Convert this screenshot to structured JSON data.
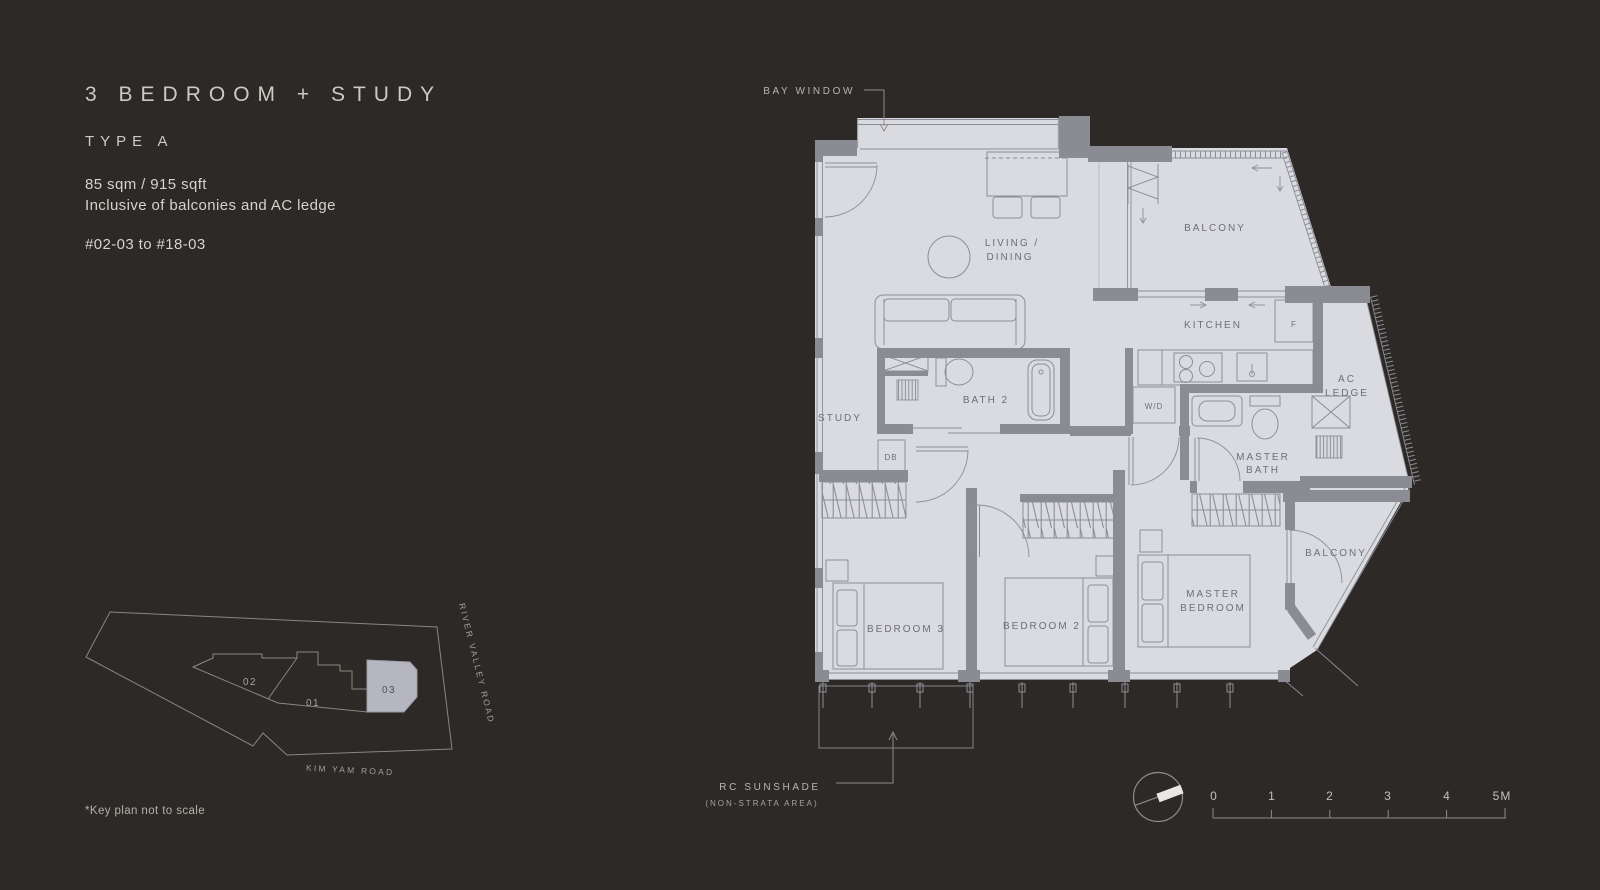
{
  "header": {
    "title": "3 BEDROOM + STUDY",
    "type": "TYPE A",
    "area": "85 sqm / 915 sqft",
    "inclusive": "Inclusive of balconies and AC ledge",
    "stack": "#02-03 to #18-03"
  },
  "plan": {
    "bay_window": "BAY WINDOW",
    "balcony_top": "BALCONY",
    "kitchen": "KITCHEN",
    "fridge": "F",
    "living_line1": "LIVING /",
    "living_line2": "DINING",
    "study": "STUDY",
    "bath2": "BATH 2",
    "wd": "W/D",
    "db": "DB",
    "master_bath_line1": "MASTER",
    "master_bath_line2": "BATH",
    "ac_line1": "AC",
    "ac_line2": "LEDGE",
    "balcony_low": "BALCONY",
    "bedroom3": "BEDROOM 3",
    "bedroom2": "BEDROOM 2",
    "master_line1": "MASTER",
    "master_line2": "BEDROOM",
    "sunshade_line1": "RC SUNSHADE",
    "sunshade_line2": "(NON-STRATA AREA)"
  },
  "keyplan": {
    "unit02": "02",
    "unit01": "01",
    "unit03": "03",
    "road_right": "RIVER VALLEY ROAD",
    "road_bottom": "KIM  YAM ROAD",
    "note": "*Key plan not to scale"
  },
  "scalebar": {
    "ticks": [
      "0",
      "1",
      "2",
      "3",
      "4",
      "5M"
    ]
  },
  "colors": {
    "background": "#2c2926",
    "floor": "#dadbe0",
    "wall": "#8b8b94",
    "text_light": "#cdc9c3",
    "room_label": "#6e6e78",
    "keyplan_highlight": "#b5b6c0"
  }
}
